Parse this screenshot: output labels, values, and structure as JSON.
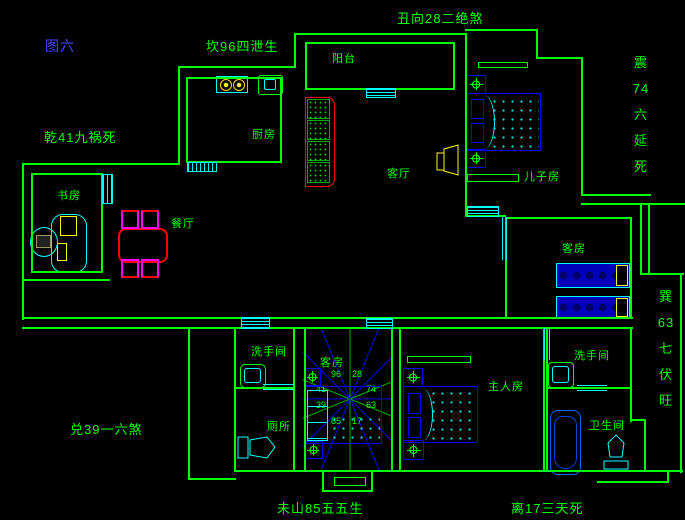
{
  "title": {
    "figure_label": "图六"
  },
  "fengshui": {
    "top": "丑向28二绝煞",
    "north_left": "坎96四泄生",
    "northwest": "乾41九祸死",
    "east": "震\n74\n六\n延\n死",
    "southeast": "巽\n63\n七\n伏\n旺",
    "west": "兑39一六煞",
    "south_left": "未山85五五生",
    "south_right": "离17三天死"
  },
  "rooms": {
    "balcony": "阳台",
    "kitchen": "厨房",
    "living_room": "客厅",
    "sons_room": "儿子房",
    "dining_room": "餐厅",
    "study": "书房",
    "guest_room_right": "客房",
    "guest_room_center": "客房",
    "washroom_left": "洗手间",
    "toilet": "厕所",
    "master_room": "主人房",
    "washroom_right": "洗手间",
    "bathroom": "卫生间"
  },
  "compass": {
    "numbers": [
      "96",
      "28",
      "74",
      "63",
      "17",
      "85",
      "39",
      "41"
    ]
  },
  "colors": {
    "wall_green": "#00ff00",
    "furniture_blue": "#0000ff",
    "fixture_cyan": "#00ffff",
    "accent_yellow": "#ffff00",
    "accent_red": "#ff0000",
    "chair_magenta": "#ff00ff",
    "figure_title_blue": "#4444ff",
    "compass_ray_blue": "#0000dd"
  }
}
